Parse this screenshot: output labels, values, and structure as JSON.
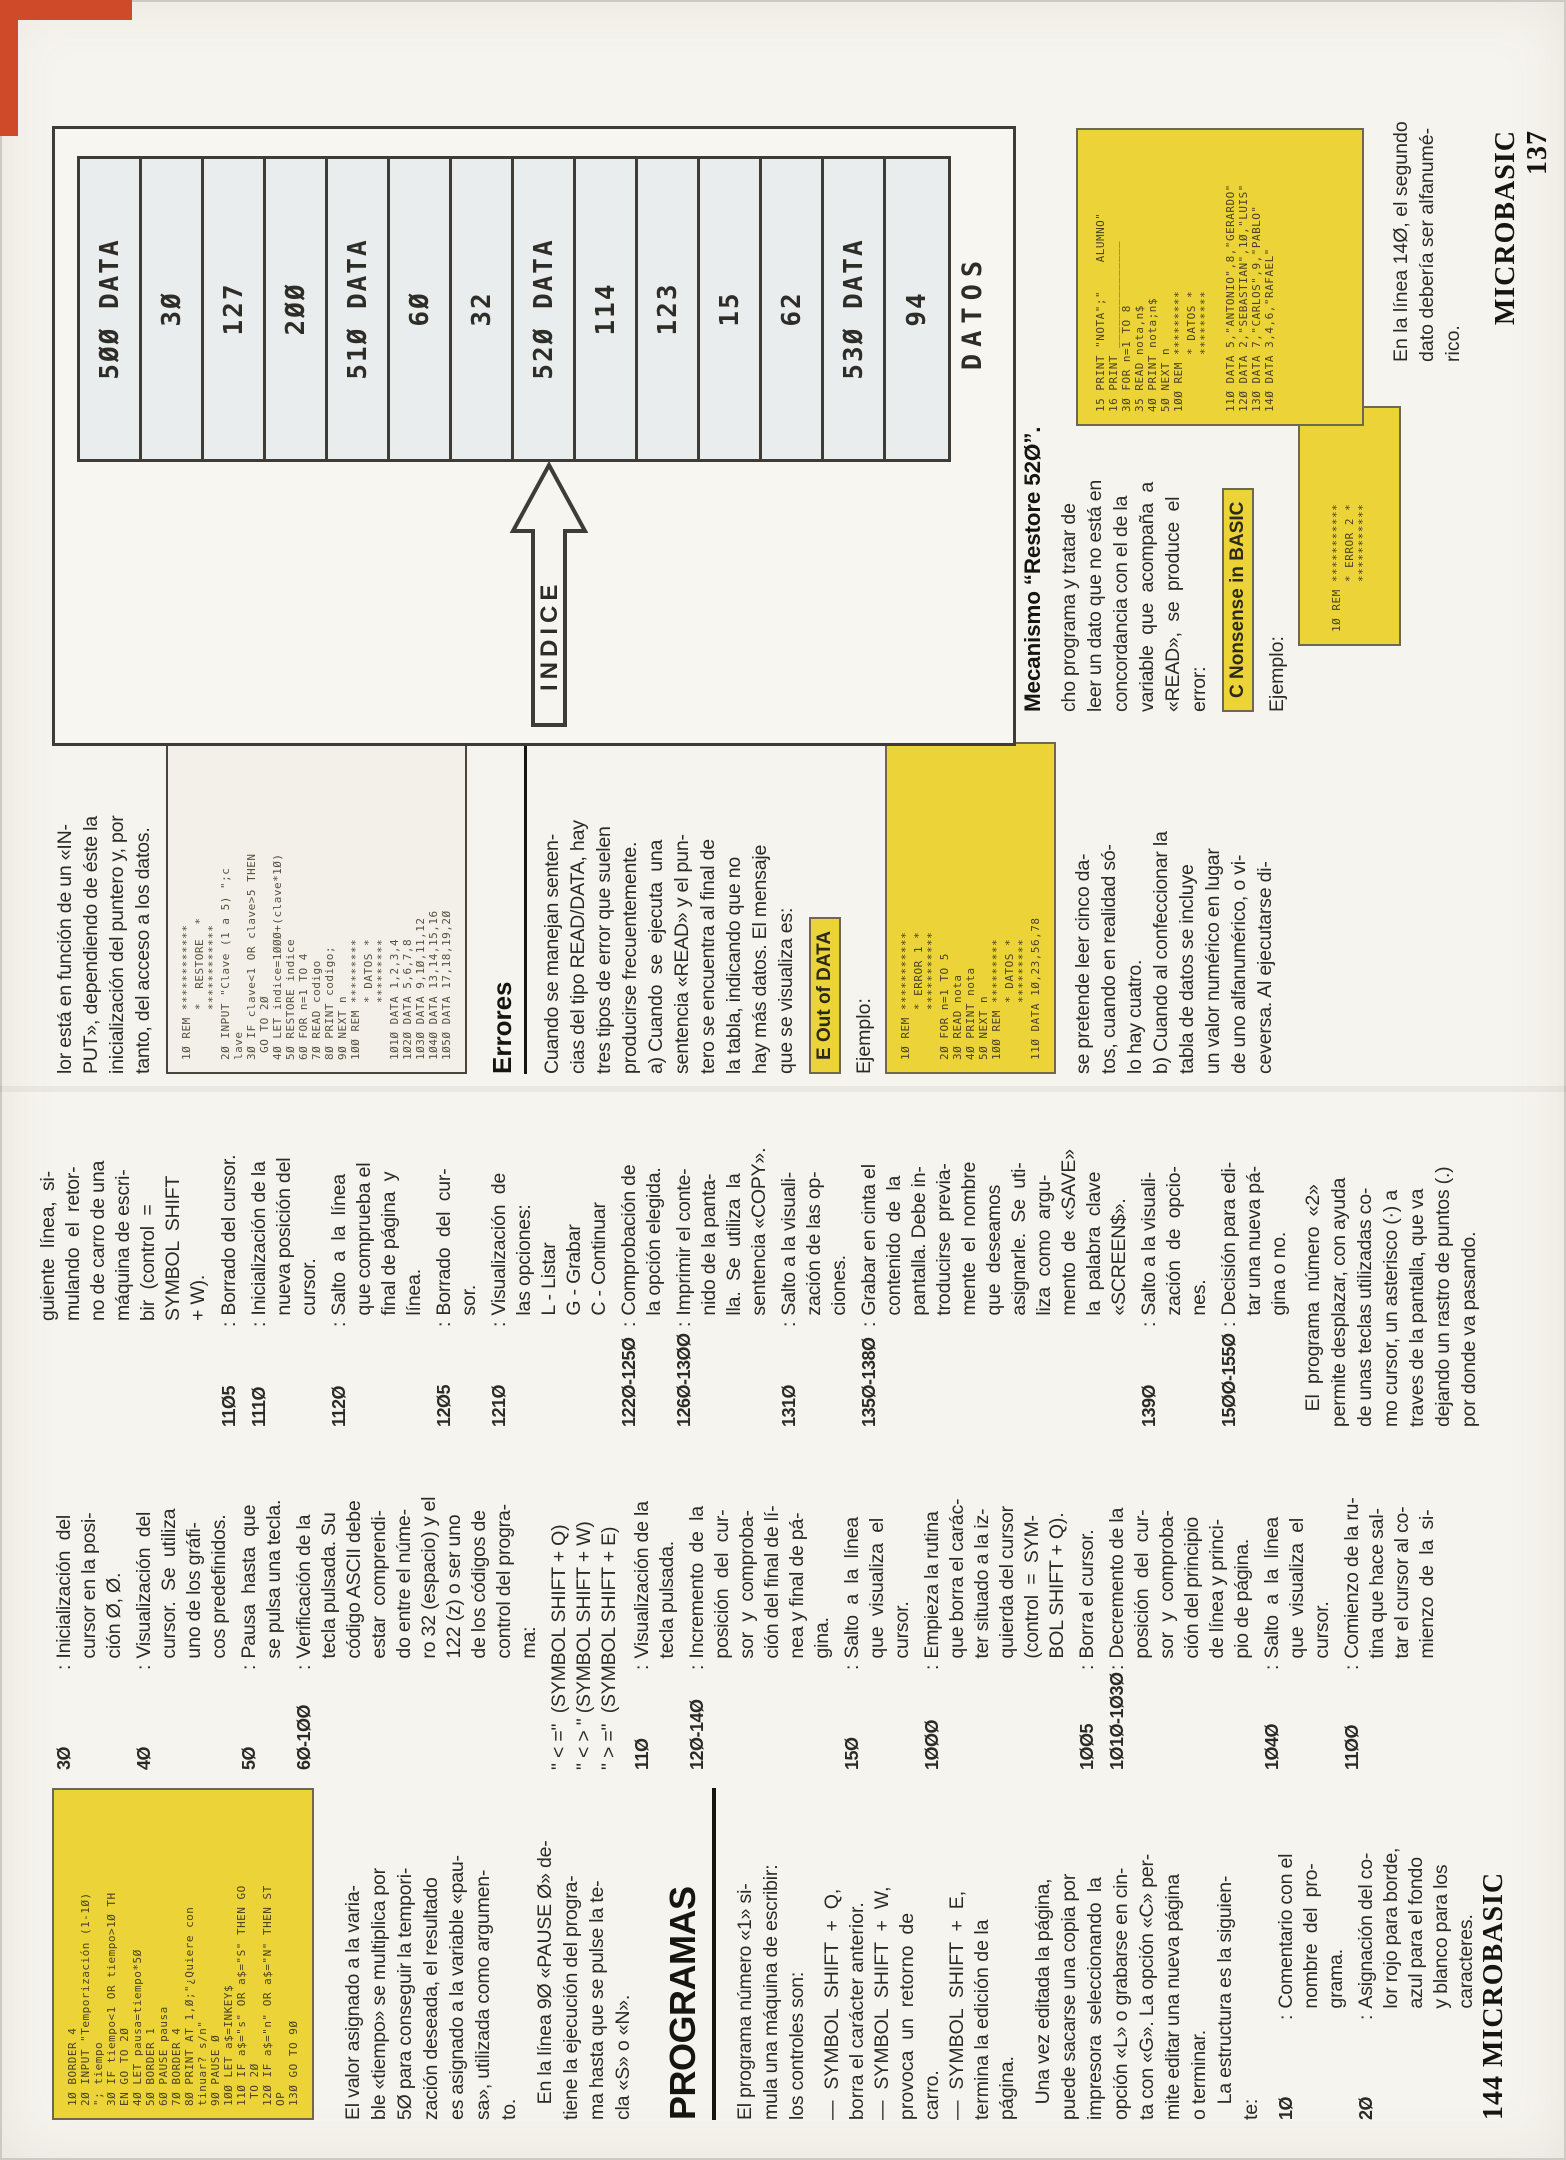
{
  "page": {
    "footer_left": "144 MICROBASIC",
    "footer_right": "MICROBASIC 137",
    "accent_yellow": "#ecd338",
    "table_cell_bg": "#e9eded",
    "red_tab": "#cf4a28"
  },
  "figure": {
    "table_rows": [
      "5ØØ  DATA",
      "3Ø",
      "127",
      "2ØØ",
      "51Ø  DATA",
      "6Ø",
      "32",
      "52Ø  DATA",
      "114",
      "123",
      "15",
      "62",
      "53Ø  DATA",
      "94"
    ],
    "arrow_label": "INDICE",
    "caption": "DATOS"
  },
  "colA": {
    "listing_timer": [
      "1Ø BORDER 4",
      "2Ø INPUT \"Temporización (1-1Ø)",
      "\"; tiempo",
      "3Ø IF tiempo<1 OR tiempo>1Ø TH",
      "EN GO TO 2Ø",
      "4Ø LET pausa=tiempo*5Ø",
      "5Ø BORDER 1",
      "6Ø PAUSE pausa",
      "7Ø BORDER 4",
      "8Ø PRINT AT 1,Ø;\"¿Quiere con",
      "tinuar? s/n\"",
      "9Ø PAUSE Ø",
      "1ØØ LET a$=INKEY$",
      "11Ø IF a$=\"s\" OR a$=\"S\" THEN GO",
      " TO 2Ø",
      "12Ø IF a$=\"n\" OR a$=\"N\" THEN ST",
      "OP",
      "13Ø GO TO 9Ø"
    ],
    "para1": [
      "El valor asignado a la varia-",
      "ble «tiempo» se multiplica por",
      "5Ø para conseguir la tempori-",
      "zación deseada, el resultado",
      "es asignado a la variable «pau-",
      "sa», utilizada como argumen-",
      "to."
    ],
    "para2": [
      "   En la línea 9Ø «PAUSE Ø» de-",
      "tiene la ejecución del progra-",
      "ma hasta que se pulse la te-",
      "cla «S» o «N»."
    ],
    "heading": "PROGRAMAS",
    "para3": [
      "El programa número «1» si-",
      "mula una máquina de escribir:",
      "los controles son:"
    ],
    "bullets": [
      "—  SYMBOL  SHIFT  +  Q,",
      "borra el carácter anterior.",
      "—  SYMBOL  SHIFT  +  W,",
      "provoca  un  retorno  de",
      "carro.",
      "—  SYMBOL  SHIFT  +  E,",
      "termina la edición de la",
      "página."
    ],
    "para4": [
      "   Una vez editada la página,",
      "puede sacarse una copia por",
      "impresora  seleccionando  la",
      "opción «L» o grabarse en cin-",
      "ta con «G». La opción «C» per-",
      "mite editar una nueva página",
      "o terminar.",
      "   La estructura es la siguien-",
      "te:"
    ],
    "entries": [
      {
        "n": "1Ø",
        "t": [
          "Comentario con el",
          "nombre  del  pro-",
          "grama."
        ]
      },
      {
        "n": "2Ø",
        "t": [
          "Asignación del co-",
          "lor rojo para borde,",
          "azul para el fondo",
          "y blanco para los",
          "caracteres."
        ]
      }
    ]
  },
  "colB": {
    "entries1": [
      {
        "n": "3Ø",
        "t": [
          "Inicialización  del",
          "cursor en la posi-",
          "ción Ø, Ø."
        ]
      },
      {
        "n": "4Ø",
        "t": [
          "Visualización  del",
          "cursor.  Se  utiliza",
          "uno de los gráfi-",
          "cos predefinidos."
        ]
      },
      {
        "n": "5Ø",
        "t": [
          "Pausa  hasta  que",
          "se pulsa una tecla."
        ]
      },
      {
        "n": "6Ø-1ØØ",
        "t": [
          "Verificación de la",
          "tecla pulsada. Su",
          "código ASCII debe",
          "estar  comprendi-",
          "do entre el núme-",
          "ro 32 (espacio) y el",
          "122 (z) o ser uno",
          "de los códigos de",
          "control del progra-",
          "ma:"
        ]
      }
    ],
    "codes": [
      "\" < =\"  (SYMBOL SHIFT + Q)",
      "\" < > \" (SYMBOL SHIFT + W)",
      "\" > =\"  (SYMBOL SHIFT + E)"
    ],
    "entries2": [
      {
        "n": "11Ø",
        "t": [
          "Visualización de la",
          "tecla pulsada."
        ]
      },
      {
        "n": "12Ø-14Ø",
        "t": [
          "Incremento  de  la",
          "posición  del  cur-",
          "sor  y  comproba-",
          "ción del final de lí-",
          "nea y final de pá-",
          "gina."
        ]
      },
      {
        "n": "15Ø",
        "t": [
          "Salto  a  la  línea",
          "que  visualiza  el",
          "cursor."
        ]
      },
      {
        "n": "1ØØØ",
        "t": [
          "Empieza la rutina",
          "que borra el carác-",
          "ter situado a la iz-",
          "quierda del cursor",
          "(control  =  SYM-",
          "BOL SHIFT + Q)."
        ]
      },
      {
        "n": "1ØØ5",
        "t": [
          "Borra el cursor."
        ]
      },
      {
        "n": "1Ø1Ø-1Ø3Ø",
        "t": [
          "Decremento de la",
          "posición  del  cur-",
          "sor  y  comproba-",
          "ción del principio",
          "de línea y princi-",
          "pio de página."
        ]
      },
      {
        "n": "1Ø4Ø",
        "t": [
          "Salto  a  la  línea",
          "que  visualiza  el",
          "cursor."
        ]
      },
      {
        "n": "11ØØ",
        "t": [
          "Comienzo de la ru-",
          "tina que hace sal-",
          "tar el cursor al co-",
          "mienzo  de  la  si-"
        ]
      }
    ]
  },
  "colC": {
    "cont": [
      "guiente  línea,  si-",
      "mulando  el  retor-",
      "no de carro de una",
      "máquina de escri-",
      "bir  (control  =",
      "SYMBOL  SHIFT",
      "+ W)."
    ],
    "entries": [
      {
        "n": "11Ø5",
        "t": [
          "Borrado del cursor."
        ]
      },
      {
        "n": "111Ø",
        "t": [
          "Inicialización de la",
          "nueva posición del",
          "cursor."
        ]
      },
      {
        "n": "112Ø",
        "t": [
          "Salto  a  la  línea",
          "que comprueba el",
          "final de página  y",
          "línea."
        ]
      },
      {
        "n": "12Ø5",
        "t": [
          "Borrado  del  cur-",
          "sor."
        ]
      },
      {
        "n": "121Ø",
        "t": [
          "Visualización  de",
          "las opciones:",
          "L - Listar",
          "G - Grabar",
          "C - Continuar"
        ]
      },
      {
        "n": "122Ø-125Ø",
        "t": [
          "Comprobación de",
          "la opción elegida."
        ]
      },
      {
        "n": "126Ø-13ØØ",
        "t": [
          "Imprimir el conte-",
          "nido de la panta-",
          "lla.  Se  utiliza  la",
          "sentencia «COPY»."
        ]
      },
      {
        "n": "131Ø",
        "t": [
          "Salto a la visuali-",
          "zación de las op-",
          "ciones."
        ]
      },
      {
        "n": "135Ø-138Ø",
        "t": [
          "Grabar en cinta el",
          "contenido  de  la",
          "pantalla. Debe in-",
          "troducirse  previa-",
          "mente  el  nombre",
          "que  deseamos",
          "asignarle.  Se  uti-",
          "liza  como  argu-",
          "mento  de  «SAVE»",
          "la  palabra  clave",
          "«SCREEN$»."
        ]
      },
      {
        "n": "139Ø",
        "t": [
          "Salto a la visuali-",
          "zación  de  opcio-",
          "nes."
        ]
      },
      {
        "n": "15ØØ-155Ø",
        "t": [
          "Decisión para edi-",
          "tar una nueva pá-",
          "gina o no."
        ]
      }
    ],
    "para": [
      "   El  programa  número  «2»",
      "permite desplazar, con ayuda",
      "de unas teclas utilizadas co-",
      "mo cursor, un asterisco (·) a",
      "traves de la pantalla, que va",
      "dejando un rastro de puntos (.)",
      "por donde va pasando."
    ]
  },
  "colE": {
    "para1": [
      "lor está en función de un «IN-",
      "PUT», dependiendo de éste la",
      "inicialización del puntero y, por",
      "tanto, del acceso a los datos."
    ],
    "listing_restore": [
      "1Ø REM ************",
      "       *  RESTORE  *",
      "       ************",
      "2Ø INPUT \"Clave (1 a 5) \";c",
      "lave",
      "3Ø IF clave<1 OR clave>5 THEN",
      " GO TO 2Ø",
      "4Ø LET indice=1ØØØ+(clave*1Ø)",
      "5Ø RESTORE indice",
      "6Ø FOR n=1 TO 4",
      "7Ø READ codigo",
      "8Ø PRINT codigo;",
      "9Ø NEXT n",
      "1ØØ REM *********",
      "        * DATOS *",
      "        *********",
      "1Ø1Ø DATA 1,2,3,4",
      "1Ø2Ø DATA 5,6,7,8",
      "1Ø3Ø DATA 9,1Ø,11,12",
      "1Ø4Ø DATA 13,14,15,16",
      "1Ø5Ø DATA 17,18,19,2Ø"
    ],
    "heading": "Errores",
    "para2": [
      "Cuando se manejan senten-",
      "cias del tipo READ/DATA, hay",
      "tres tipos de error que suelen",
      "producirse frecuentemente.",
      "a) Cuando  se  ejecuta  una",
      "sentencia «READ» y el pun-",
      "tero se encuentra al final de",
      "la tabla, indicando que no",
      "hay más datos. El mensaje",
      "que se visualiza es:"
    ],
    "label": "E Out of DATA",
    "ejemplo": "Ejemplo:",
    "listing_error1": [
      "1Ø REM ***********",
      "       * ERROR 1 *",
      "       ***********",
      "2Ø FOR n=1 TO 5",
      "3Ø READ nota",
      "4Ø PRINT nota",
      "5Ø NEXT n",
      "1ØØ REM *********",
      "        * DATOS *",
      "        *********",
      "11Ø DATA 1Ø,23,56,78"
    ],
    "para3": [
      "se pretende leer cinco da-",
      "tos, cuando en realidad só-",
      "lo hay cuatro.",
      "b) Cuando al confeccionar la",
      "tabla de datos se incluye",
      "un valor numérico en lugar",
      "de uno alfanumérico, o vi-",
      "ceversa. Al ejecutarse di-"
    ]
  },
  "colF": {
    "heading": "Mecanismo “Restore 52Ø”.",
    "para": [
      "cho programa y tratar de",
      "leer un dato que no está en",
      "concordancia con el de la",
      "variable  que  acompaña  a",
      "«READ»,  se  produce  el",
      "error:"
    ],
    "label": "C Nonsense in BASIC",
    "ejemplo": "Ejemplo:",
    "listing_error2": [
      "1Ø REM ***********",
      "       * ERROR 2 *",
      "       ***********"
    ]
  },
  "colG": {
    "listing_notas": [
      "15 PRINT \"NOTA\";\"    ALUMNO\"",
      "16 PRINT _______________",
      "3Ø FOR n=1 TO 8",
      "35 READ nota,n$",
      "4Ø PRINT nota;n$",
      "5Ø NEXT n",
      "1ØØ REM *********",
      "        * DATOS *",
      "        *********",
      " ",
      "11Ø DATA 5,\"ANTONIO\",8,\"GERARDO\"",
      "12Ø DATA 2,\"SEBASTIAN\",1Ø,\"LUIS\"",
      "13Ø DATA 7,\"CARLOS\",9,\"PABLO\"",
      "14Ø DATA 3,4,6,\"RAFAEL\""
    ],
    "caption": [
      "En la línea 14Ø, el segundo",
      "dato debería ser alfanumé-",
      "rico."
    ]
  }
}
